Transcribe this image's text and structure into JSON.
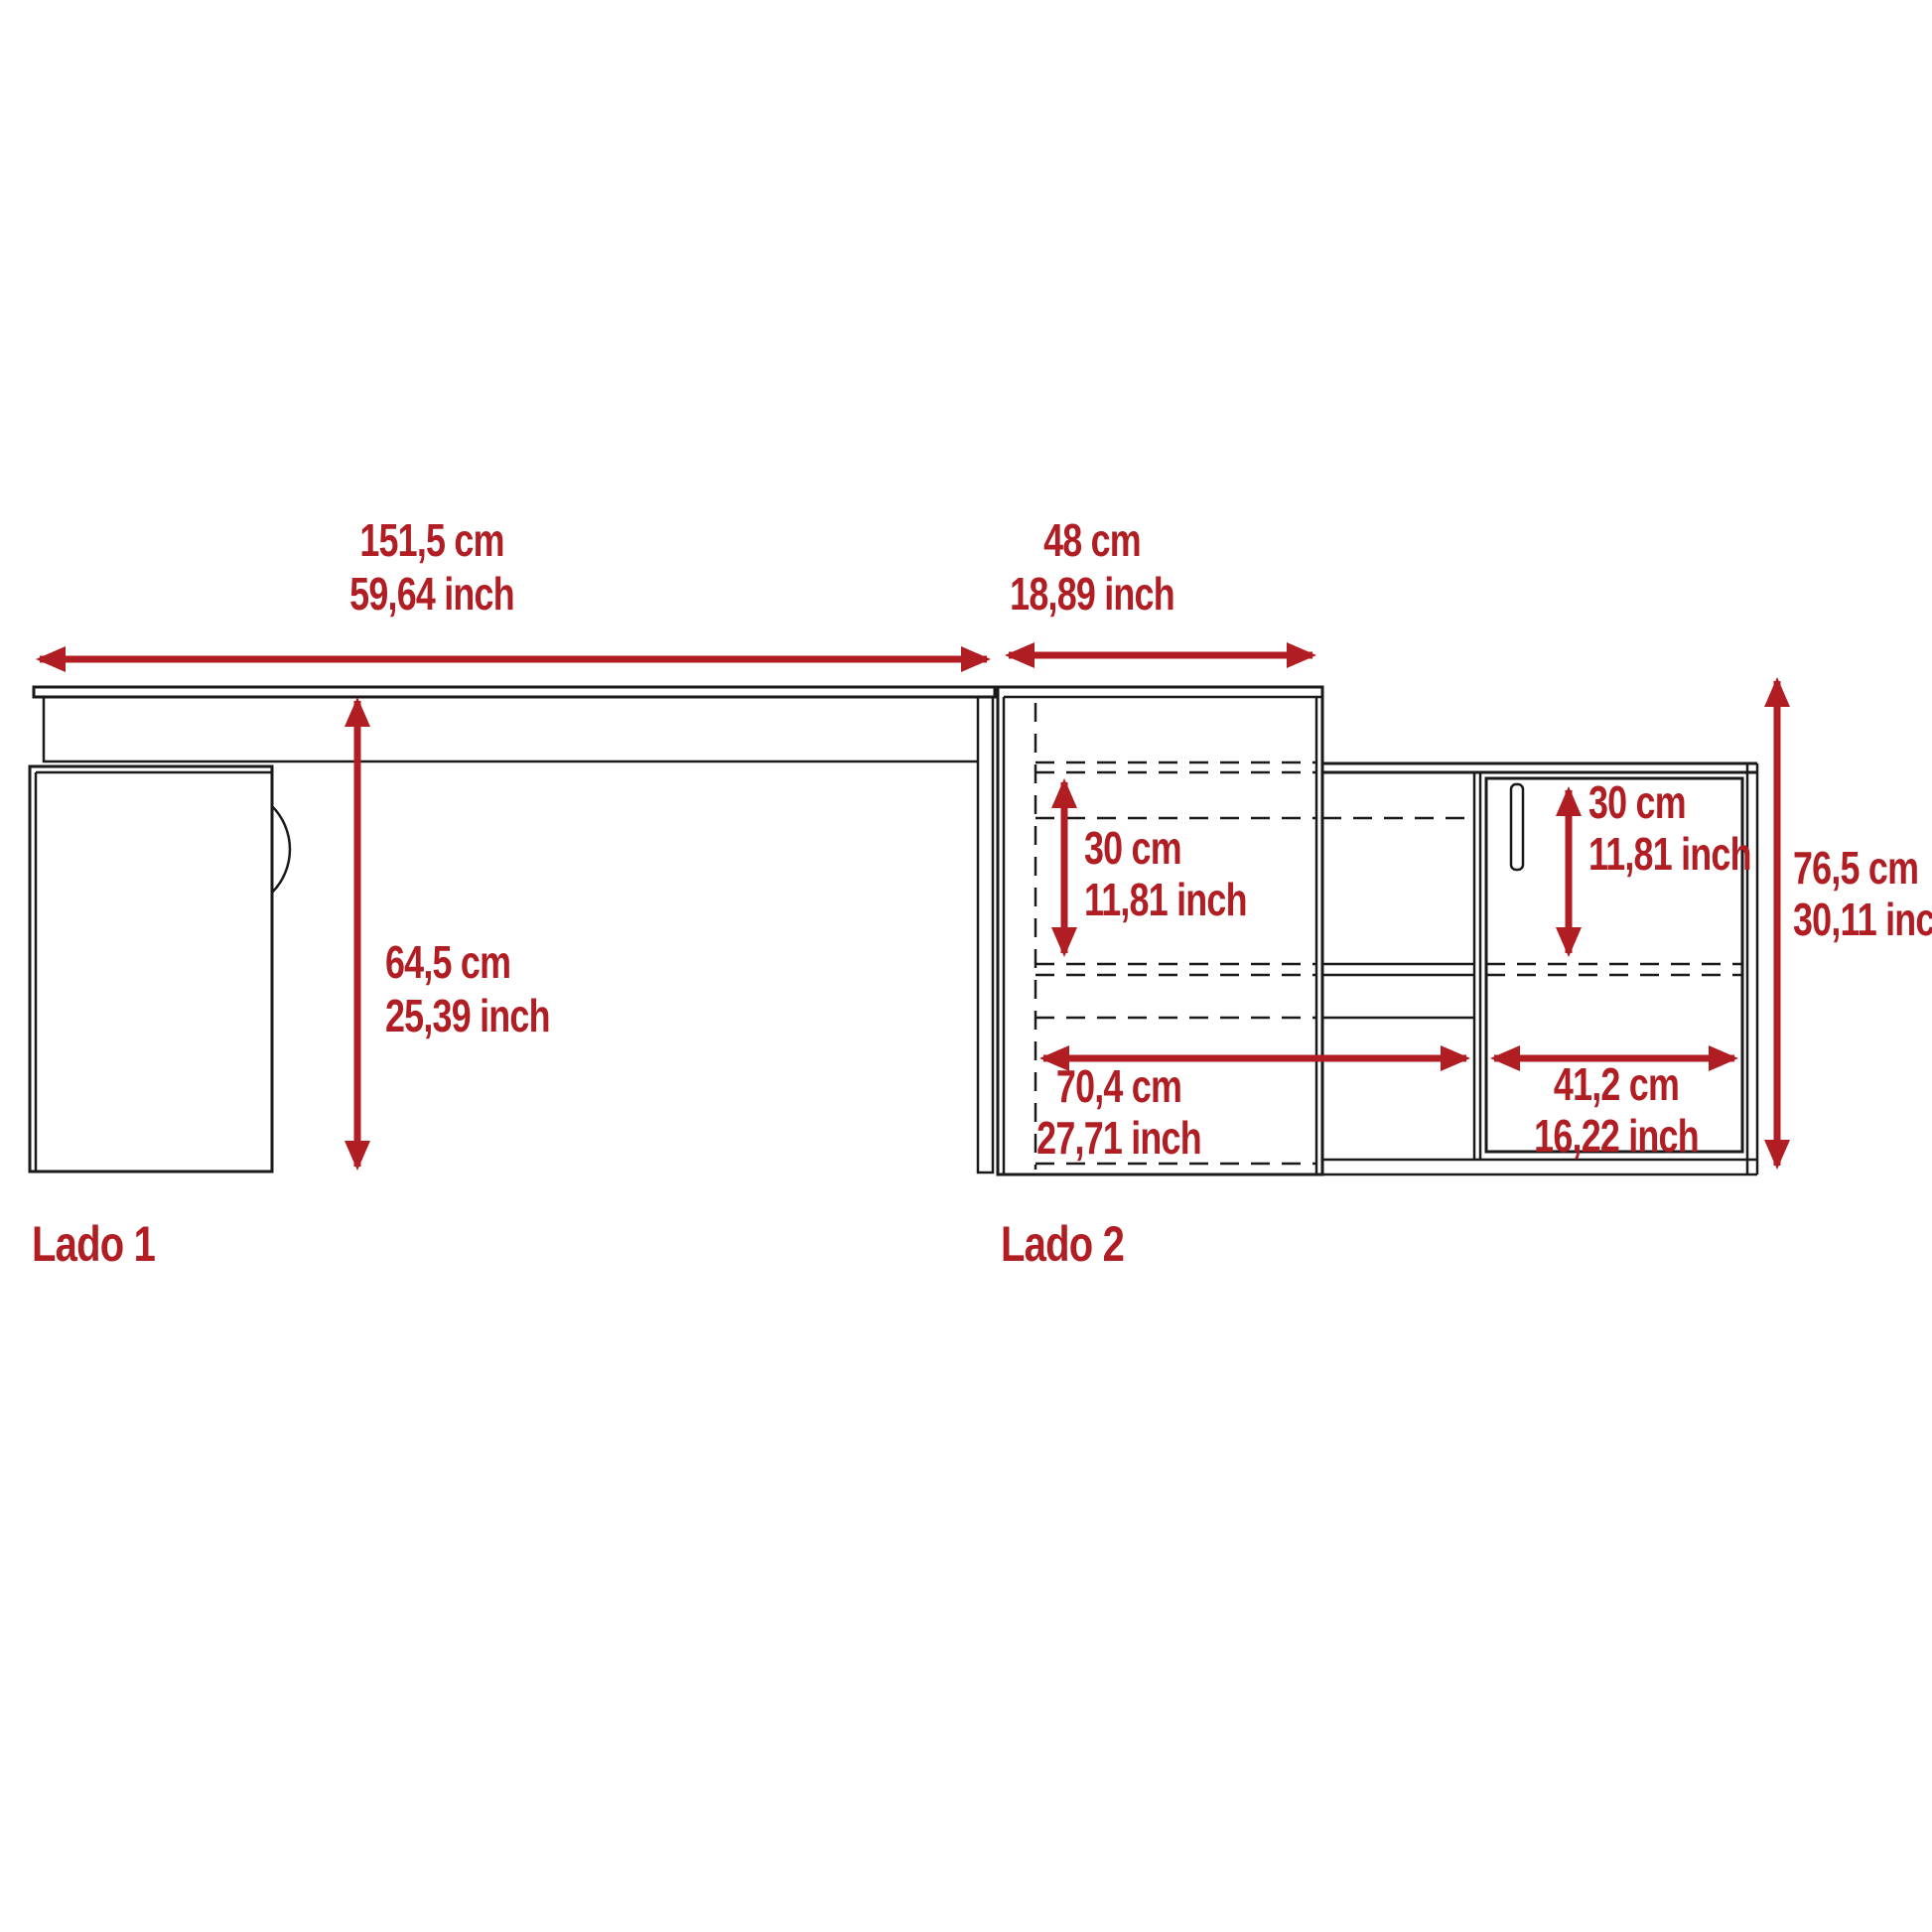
{
  "colors": {
    "accent": "#b01e24",
    "line": "#1a1a1a",
    "background": "#ffffff"
  },
  "side1": {
    "label": "Lado 1",
    "width": {
      "cm": "151,5 cm",
      "inch": "59,64 inch"
    },
    "clearance_height": {
      "cm": "64,5 cm",
      "inch": "25,39 inch"
    }
  },
  "side2": {
    "label": "Lado 2",
    "depth": {
      "cm": "48 cm",
      "inch": "18,89 inch"
    },
    "left_shelf_height": {
      "cm": "30 cm",
      "inch": "11,81 inch"
    },
    "right_shelf_height": {
      "cm": "30 cm",
      "inch": "11,81 inch"
    },
    "open_section_width": {
      "cm": "70,4 cm",
      "inch": "27,71 inch"
    },
    "door_width": {
      "cm": "41,2 cm",
      "inch": "16,22 inch"
    },
    "total_height": {
      "cm": "76,5 cm",
      "inch": "30,11 inch"
    }
  }
}
